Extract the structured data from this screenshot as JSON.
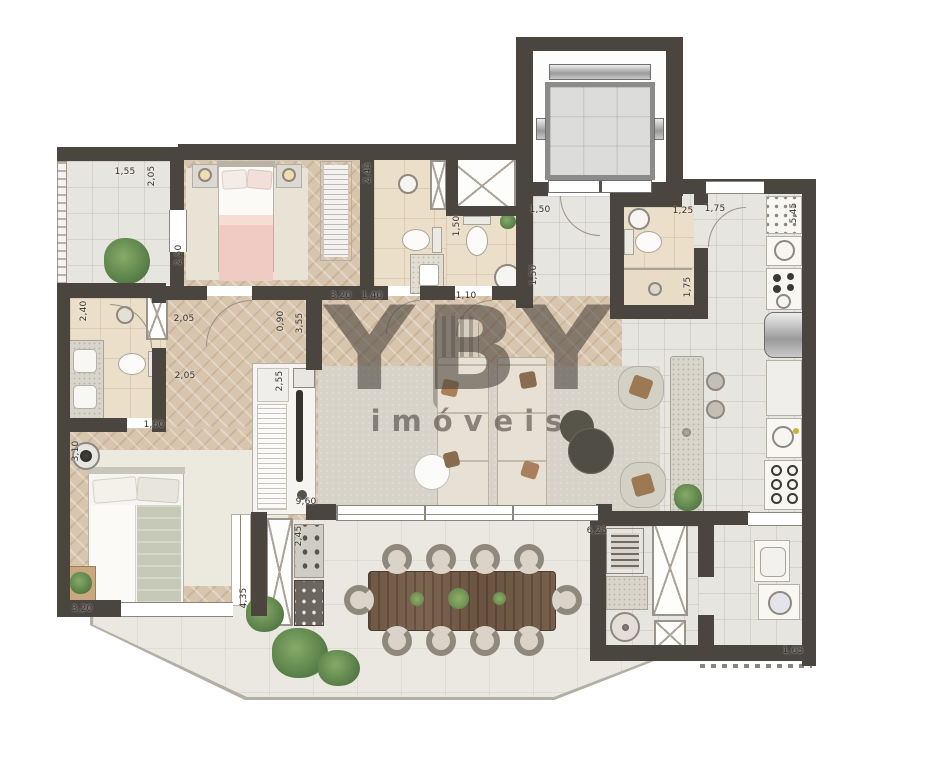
{
  "watermark": {
    "brand": "YBY",
    "tagline": "imóveis"
  },
  "dimension_labels": [
    {
      "text": "1,55"
    },
    {
      "text": "2,05"
    },
    {
      "text": "2,50"
    },
    {
      "text": "3,20"
    },
    {
      "text": "1,40"
    },
    {
      "text": "2,45"
    },
    {
      "text": "1,50"
    },
    {
      "text": "1,10"
    },
    {
      "text": "1,50"
    },
    {
      "text": "1,50"
    },
    {
      "text": "1,25"
    },
    {
      "text": "1,75"
    },
    {
      "text": "1,75"
    },
    {
      "text": "5,45"
    },
    {
      "text": "2,40"
    },
    {
      "text": "2,05"
    },
    {
      "text": "0,90"
    },
    {
      "text": "3,55"
    },
    {
      "text": "2,05"
    },
    {
      "text": "2,55"
    },
    {
      "text": "1,60"
    },
    {
      "text": "3,10"
    },
    {
      "text": "9,60"
    },
    {
      "text": "4,35"
    },
    {
      "text": "3,20"
    },
    {
      "text": "2,45"
    },
    {
      "text": "6,25"
    },
    {
      "text": "1,65"
    }
  ],
  "colors": {
    "wall": "#4a453e",
    "wood_floor": "#d8c5ae",
    "tile_floor": "#e7e5e0",
    "bath_tile": "#ecdfca",
    "terrace_floor": "#eae8e1",
    "bed_pink": "#f0cbc3",
    "bed_sage": "#c6c8b8",
    "table_wood": "#6e5742",
    "plant_green": "#5a8149"
  }
}
